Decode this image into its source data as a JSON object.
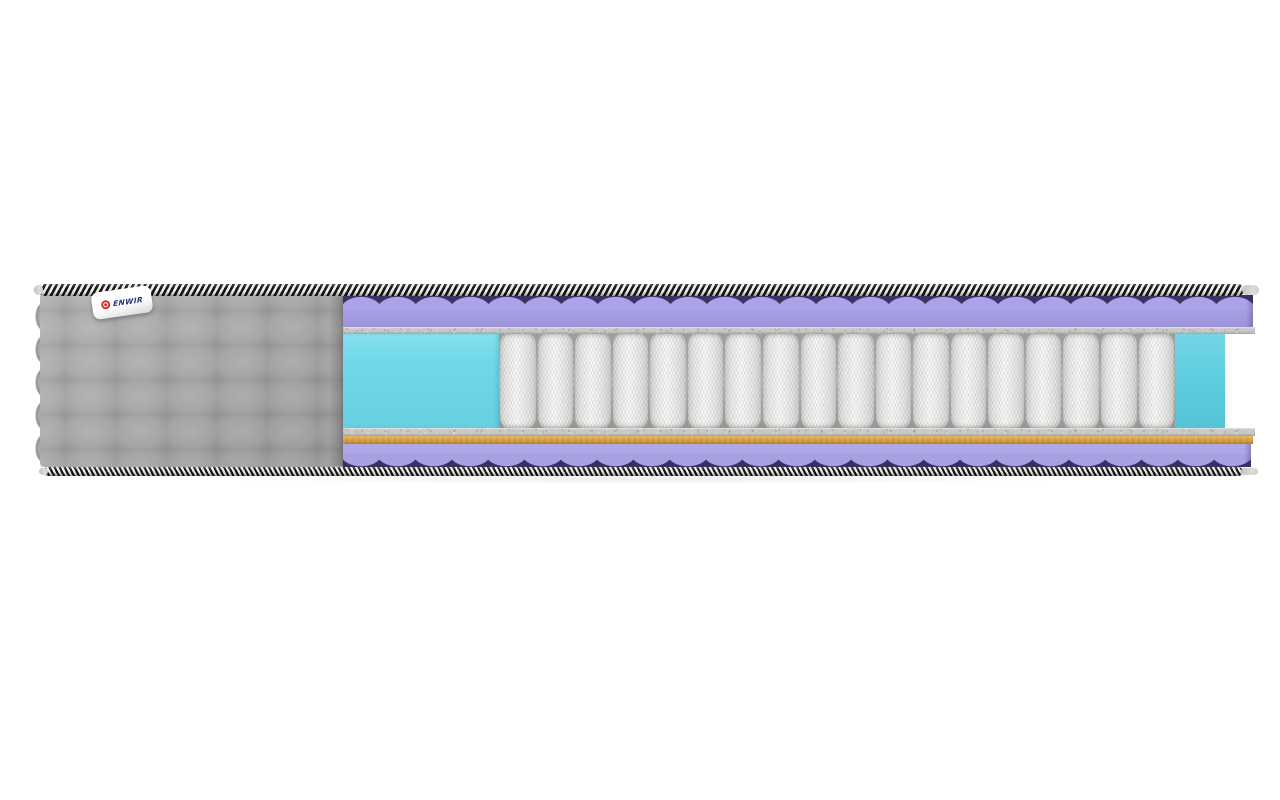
{
  "image": {
    "type": "product-photo",
    "subject": "Cross-section cutaway of a pocket-spring mattress on a white background",
    "background_color": "#ffffff"
  },
  "brand_label": {
    "text": "ENWIR",
    "logo": "red-ring-icon",
    "logo_color": "#d6332c",
    "text_color": "#26337e",
    "tag_color": "#ffffff"
  },
  "springs": {
    "count": 18,
    "color": "#f0f0ee"
  },
  "layers": [
    {
      "name": "edge-piping-top",
      "style": "black-white diagonal striped cord",
      "colors": [
        "#171717",
        "#ededeb"
      ]
    },
    {
      "name": "quilted-cover",
      "color": "#a1a1a1",
      "pattern": "square quilting",
      "columns": 6,
      "rows": 5
    },
    {
      "name": "wave-foam-top",
      "color": "#a69de2",
      "valley_color": "#3b3263"
    },
    {
      "name": "felt-pad-top",
      "color": "#c8c8c6"
    },
    {
      "name": "foam-block-left",
      "color": "#70d8e8"
    },
    {
      "name": "pocket-spring-block",
      "color": "#f0f0ee",
      "spring_count": 18
    },
    {
      "name": "foam-block-right",
      "color": "#5ecddf"
    },
    {
      "name": "felt-pad-bottom",
      "color": "#c8c8c6"
    },
    {
      "name": "coir-layer",
      "color": "#d7a044"
    },
    {
      "name": "wave-foam-bottom",
      "color": "#a8a0e3",
      "valley_color": "#39305e"
    },
    {
      "name": "edge-piping-bottom",
      "style": "black-white diagonal striped cord",
      "colors": [
        "#171717",
        "#ededeb"
      ]
    }
  ]
}
